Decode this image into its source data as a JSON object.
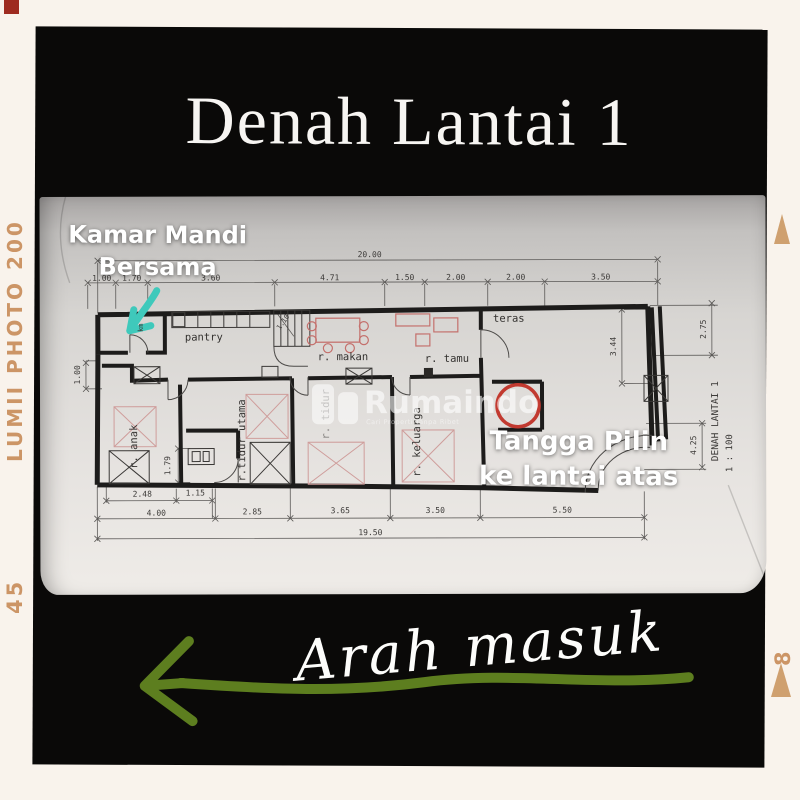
{
  "frame": {
    "film_label": "LUMII PHOTO 200",
    "counter_left": "45",
    "counter_right": "8"
  },
  "title": "Denah Lantai 1",
  "overlays": {
    "bathroom": {
      "line1": "Kamar Mandi",
      "line2": "Bersama"
    },
    "stairs": {
      "line1": "Tangga Pilin",
      "line2": "ke lantai atas"
    },
    "entrance": "Arah masuk"
  },
  "watermark": {
    "brand": "Rumaindo",
    "tagline": "Cari Properti Tanpa Ribet"
  },
  "floorplan": {
    "rooms": {
      "pantry": "pantry",
      "dining": "r. makan",
      "living": "r. tamu",
      "terrace": "teras",
      "bathroom_small": "km",
      "kids": "r. anak",
      "master": "r.tidur utama",
      "bedroom": "r. tidur",
      "family": "r. keluarga"
    },
    "sheet": {
      "title": "DENAH LANTAI 1",
      "scale": "1 : 100"
    },
    "dims": {
      "top_overall": "20.00",
      "top": [
        "1.00",
        "1.70",
        "3.60",
        "4.71",
        "1.50",
        "2.00",
        "2.00",
        "3.50"
      ],
      "bottom_upper": [
        "2.48",
        "1.15"
      ],
      "bottom": [
        "4.00",
        "2.85",
        "3.65",
        "3.50",
        "5.50"
      ],
      "bottom_overall": "19.50",
      "right": [
        "3.44",
        "2.75",
        "4.25"
      ],
      "left": [
        "1.00"
      ],
      "inner": [
        "1.79",
        "1.10"
      ]
    }
  },
  "colors": {
    "border_cream": "#f9f3ec",
    "film_tan": "#cc9566",
    "marker_red": "#9e2b20",
    "arrow_green": "#5d7e1f",
    "pointer_teal": "#3fc9bb",
    "stair_circle_red": "#c23a30",
    "frame_black": "#0a0908"
  }
}
